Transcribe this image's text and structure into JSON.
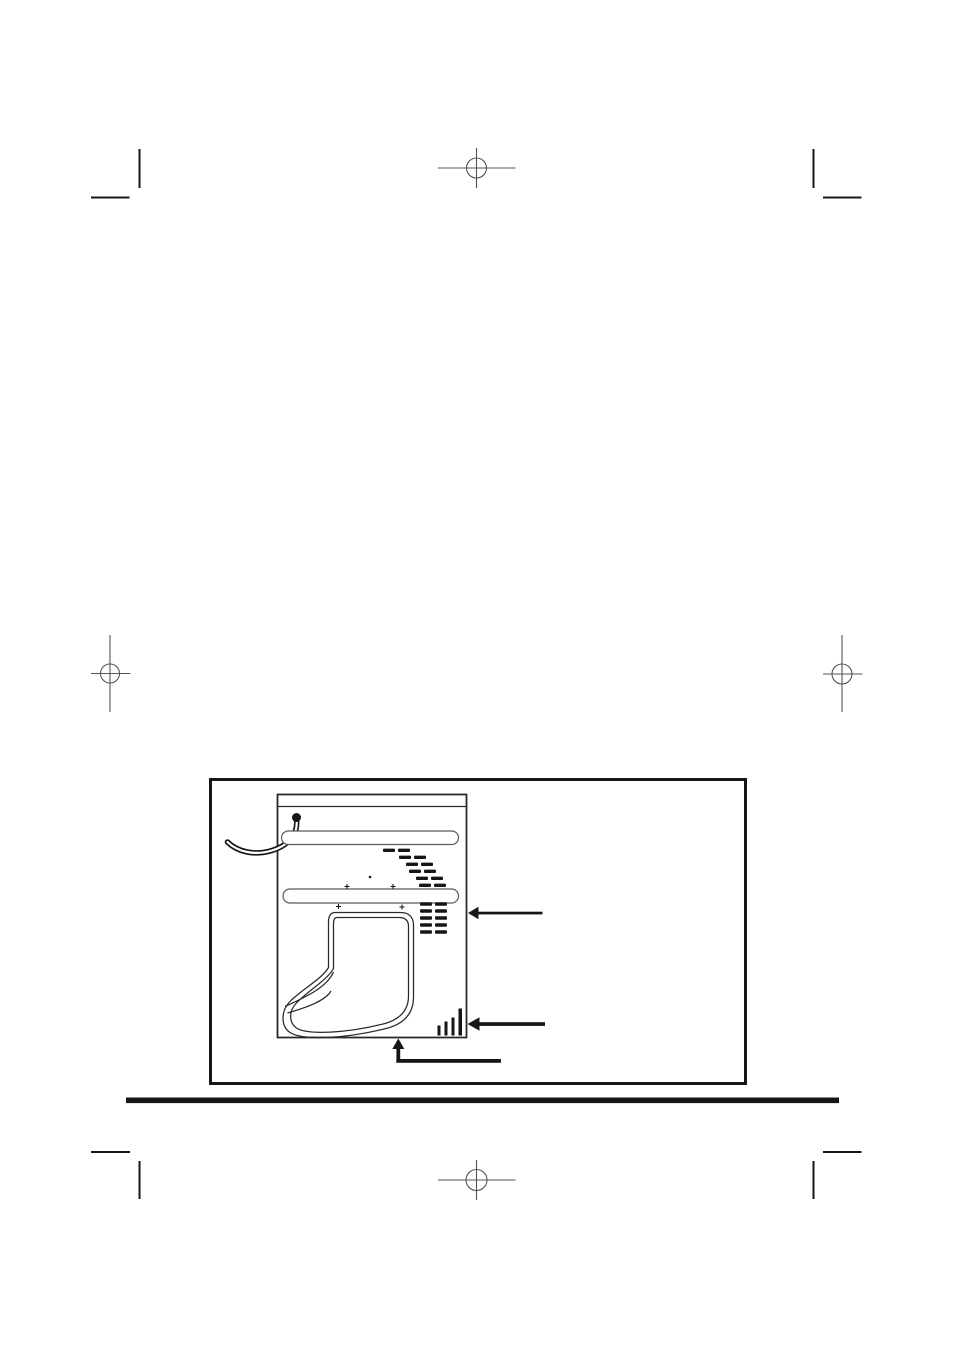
{
  "colors": {
    "paper": "#ffffff",
    "ink": "#161616",
    "diagram_line": "#2a2a2a",
    "mark_gray": "#555555",
    "brace_gray": "#5a5a5a"
  },
  "printers_marks": {
    "registration_targets": [
      {
        "name": "top-center-registration-target",
        "shape": "circle-crosshair"
      },
      {
        "name": "left-middle-registration-target",
        "shape": "circle-crosshair"
      },
      {
        "name": "right-middle-registration-target",
        "shape": "circle-crosshair"
      },
      {
        "name": "bottom-center-registration-target",
        "shape": "circle-crosshair"
      }
    ],
    "corner_ticks": [
      "top-left",
      "top-right",
      "bottom-left",
      "bottom-right"
    ]
  },
  "figure": {
    "subject": "washing-machine-rear-view",
    "has_border": true,
    "parts": [
      "power-cord",
      "power-cord-plug",
      "upper-rear-brace",
      "lower-rear-brace",
      "upper-vent-louvres",
      "lower-vent-louvres",
      "screw-marks",
      "drain-hose-loop",
      "drain-outlet-ribs"
    ],
    "callout_arrows": [
      {
        "name": "upper-callout-arrow",
        "direction": "left"
      },
      {
        "name": "lower-callout-arrow",
        "direction": "left"
      },
      {
        "name": "bottom-callout-arrow",
        "direction": "up"
      }
    ],
    "louvre_rows_upper": 6,
    "louvre_rows_lower": 5
  },
  "footer": {
    "divider_rule": true
  }
}
